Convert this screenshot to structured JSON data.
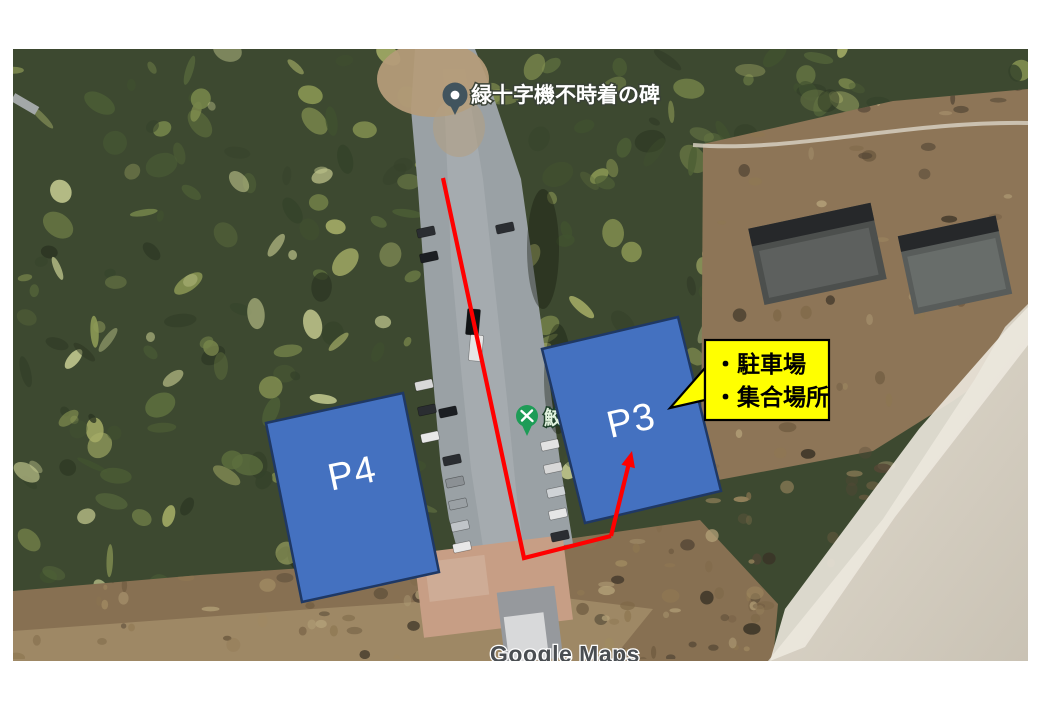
{
  "map": {
    "monument_pin_label": "緑十字機不時着の碑",
    "poi_pin_label": "鮫",
    "watermark": "Google Maps"
  },
  "annotations": {
    "p4_label": "P4",
    "p3_label": "P3",
    "callout_line1": "・駐車場",
    "callout_line2": "・集合場所"
  },
  "colors": {
    "parking_rect_fill": "#4471C0",
    "parking_rect_border": "#1F3864",
    "callout_fill": "#FFFF00",
    "callout_border": "#000000",
    "route_red": "#FF0000",
    "poi_pin_green": "#1E9C57",
    "monument_pin_gray": "#41545E"
  }
}
